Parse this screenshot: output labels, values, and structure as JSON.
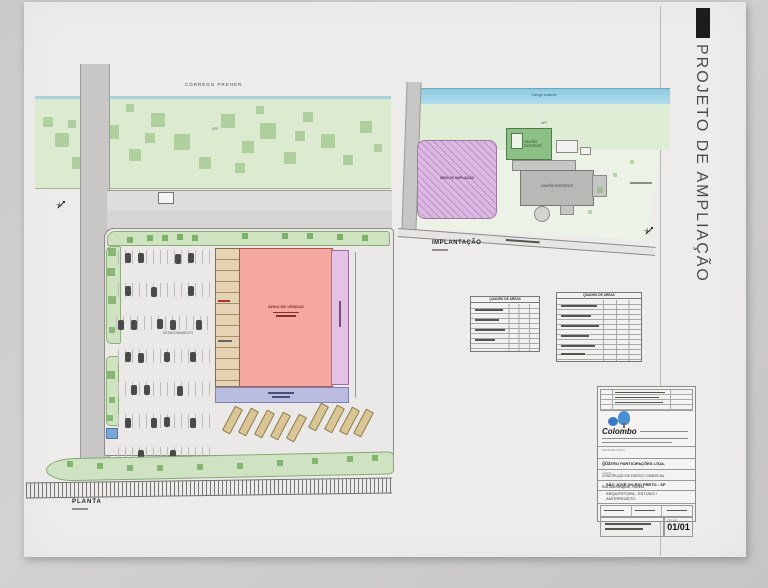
{
  "sheet": {
    "title": "PROJETO DE AMPLIAÇÃO"
  },
  "planta": {
    "label": "PLANTA",
    "corrego": "CÓRREGO PREHER",
    "app": "APP",
    "area_vendas": "ÁREA DE VENDAS"
  },
  "implantacao": {
    "label": "IMPLANTAÇÃO",
    "corrego": "Córrego existente",
    "app": "APP",
    "area_ampliacao": "ÁREA DE AMPLIAÇÃO",
    "galpao_existente": "GALPÃO EXISTENTE",
    "galpao_existente2": "GALPÃO EXISTENTE"
  },
  "tables": {
    "left_title": "QUADRO DE ÁREAS",
    "right_title": "QUADRO DE ÁREAS"
  },
  "titleblock": {
    "logo": "Colombo",
    "owner_label": "PROPRIETÁRIO:",
    "owner": "QUATRO PARTICIPAÇÕES LTDA.",
    "work_label": "OBRA:",
    "work": "CONSTRUÇÃO DE EDIFÍCIO COMERCIAL",
    "local_label": "LOCAL:",
    "address": "Rua João Mesquita - Ribeirão",
    "city": "SÃO JOSÉ DO RIO PRETO - SP",
    "project": "ARQUITETURA - ESTUDO /",
    "project2": "ANTEPROJETO",
    "folha_label": "FOLHA:",
    "folha": "01/01"
  }
}
